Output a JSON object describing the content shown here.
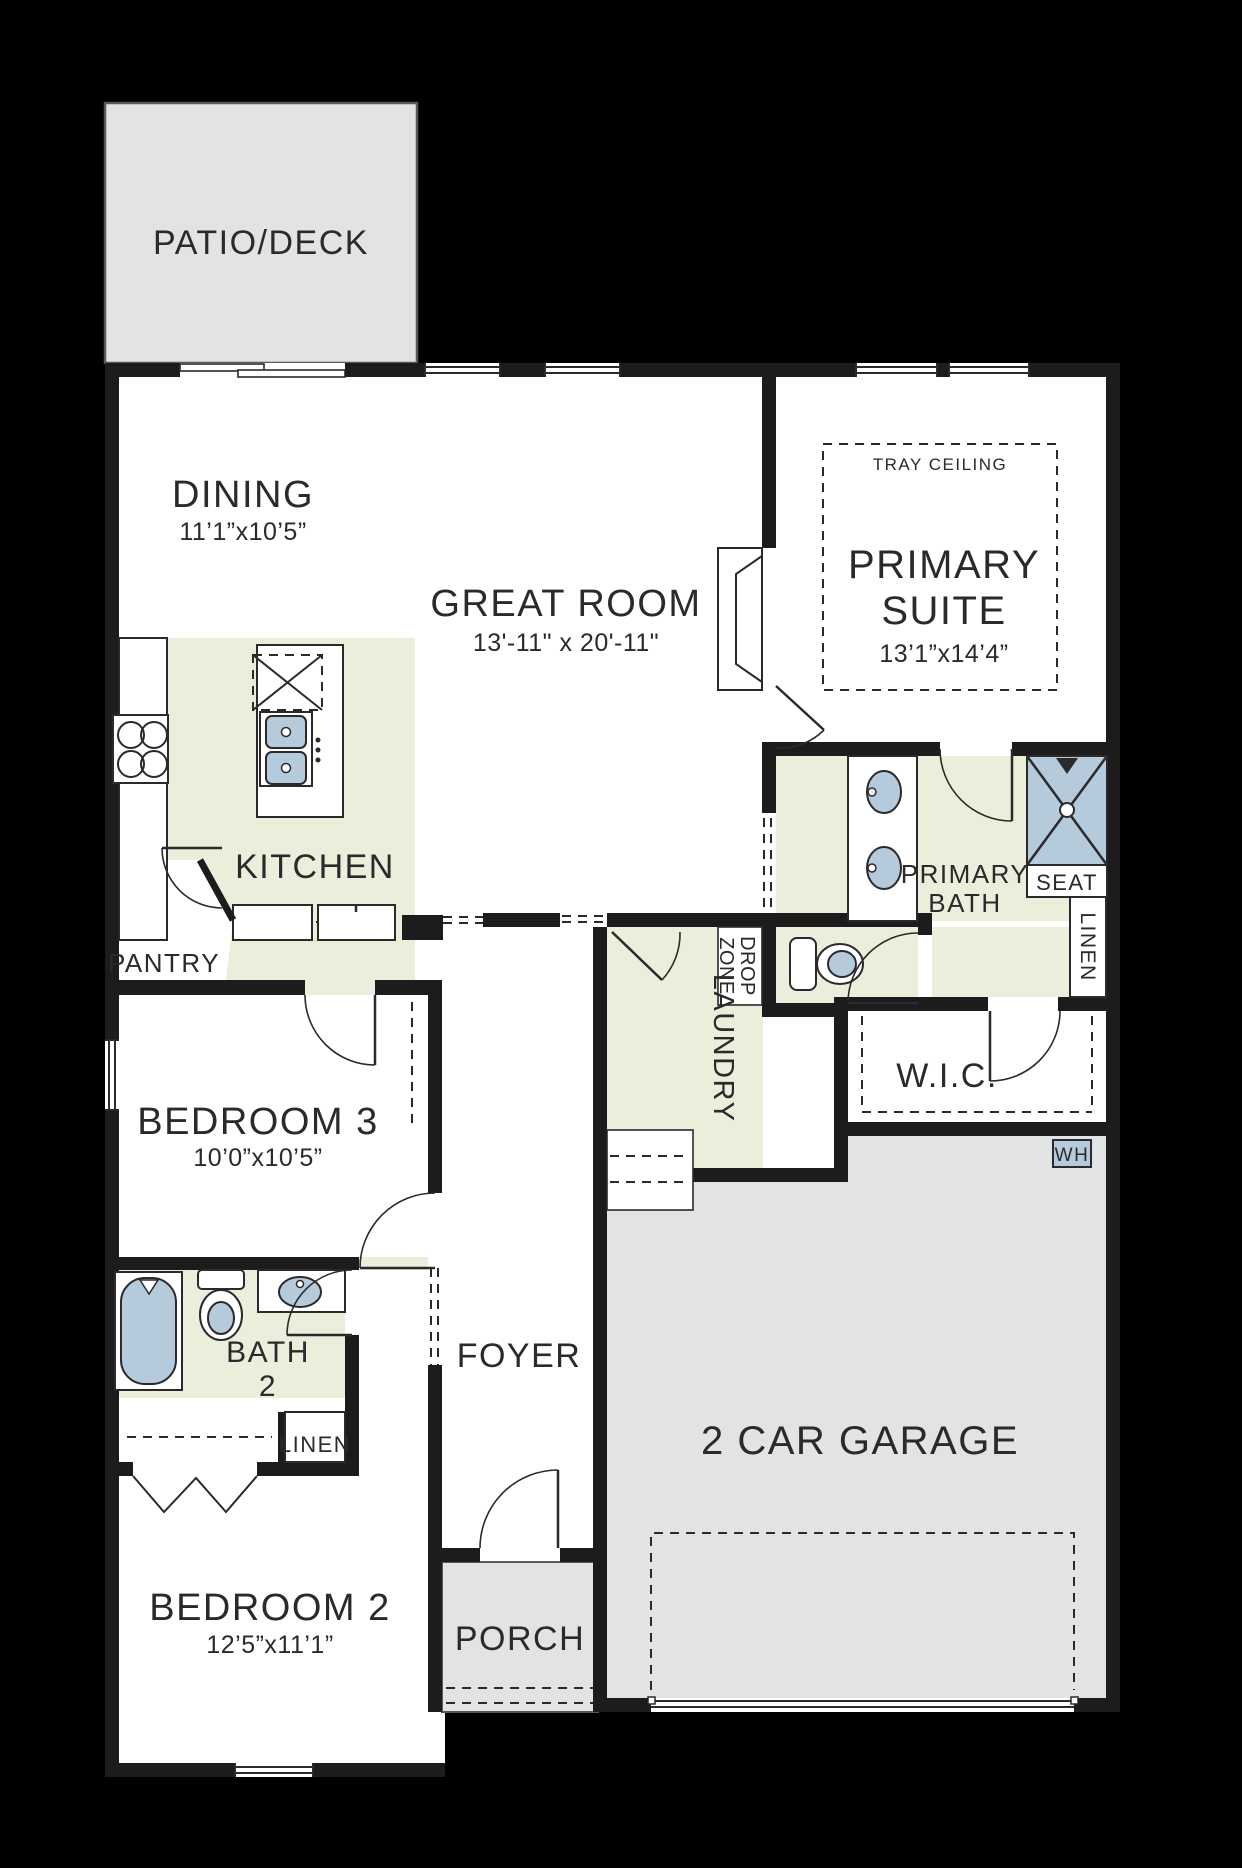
{
  "plan": {
    "patio": {
      "label": "PATIO/DECK"
    },
    "dining": {
      "label": "DINING",
      "dims": "11’1”x10’5”"
    },
    "great_room": {
      "label": "GREAT ROOM",
      "dims": "13'-11\" x 20'-11\""
    },
    "primary_suite": {
      "label_line1": "PRIMARY",
      "label_line2": "SUITE",
      "dims": "13’1”x14’4”",
      "tray_ceiling": "TRAY CEILING"
    },
    "kitchen": {
      "label": "KITCHEN"
    },
    "pantry": {
      "label": "PANTRY"
    },
    "primary_bath": {
      "label_line1": "PRIMARY",
      "label_line2": "BATH",
      "seat": "SEAT",
      "linen": "LINEN"
    },
    "wic": {
      "label": "W.I.C."
    },
    "water_heater": {
      "label": "WH"
    },
    "drop_zone": {
      "label_line1": "DROP",
      "label_line2": "ZONE"
    },
    "laundry": {
      "label": "LAUNDRY"
    },
    "bedroom3": {
      "label": "BEDROOM 3",
      "dims": "10’0”x10’5”"
    },
    "bath2": {
      "label_line1": "BATH",
      "label_line2": "2",
      "linen": "LINEN"
    },
    "bedroom2": {
      "label": "BEDROOM 2",
      "dims": "12’5”x11’1”"
    },
    "foyer": {
      "label": "FOYER"
    },
    "porch": {
      "label": "PORCH"
    },
    "garage": {
      "label": "2 CAR GARAGE"
    }
  },
  "colors": {
    "background": "#000000",
    "floor": "#ffffff",
    "wall": "#1d1b1c",
    "outdoor_gray": "#e2e3e4",
    "interior_green": "#e9efdb",
    "fixture_blue": "#b5cbdc"
  }
}
